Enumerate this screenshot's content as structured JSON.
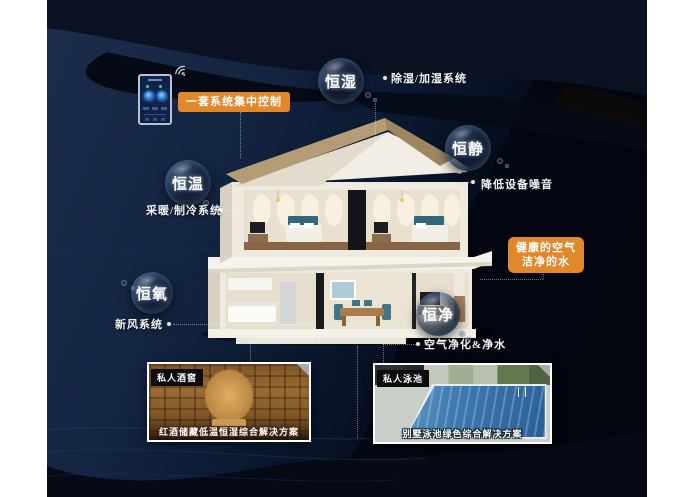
{
  "callouts": {
    "central_control": "一套系统集中控制",
    "healthy_air": {
      "line1": "健康的空气",
      "line2": "洁净的水"
    }
  },
  "bubbles": [
    {
      "id": "hengshi",
      "label": "恒湿",
      "annotation": "除湿/加湿系统"
    },
    {
      "id": "hengjing",
      "label": "恒静",
      "annotation": "降低设备噪音"
    },
    {
      "id": "hengwen",
      "label": "恒温",
      "annotation": "采暖/制冷系统"
    },
    {
      "id": "hengyang",
      "label": "恒氧",
      "annotation": "新风系统"
    },
    {
      "id": "hengjin",
      "label": "恒净",
      "annotation": "空气净化&净水"
    }
  ],
  "photos": [
    {
      "tag": "私人酒窖",
      "caption": "红酒储藏低温恒湿综合解决方案"
    },
    {
      "tag": "私人泳池",
      "caption": "别墅泳池绿色综合解决方案"
    }
  ],
  "icons": {
    "wifi": "wifi-signal",
    "phone": "smart-home-app-remote"
  },
  "colors": {
    "accent_orange": "#E0882A",
    "background_navy": "#12203A",
    "background_black": "#05080F",
    "text_white": "#FFFFFF"
  }
}
